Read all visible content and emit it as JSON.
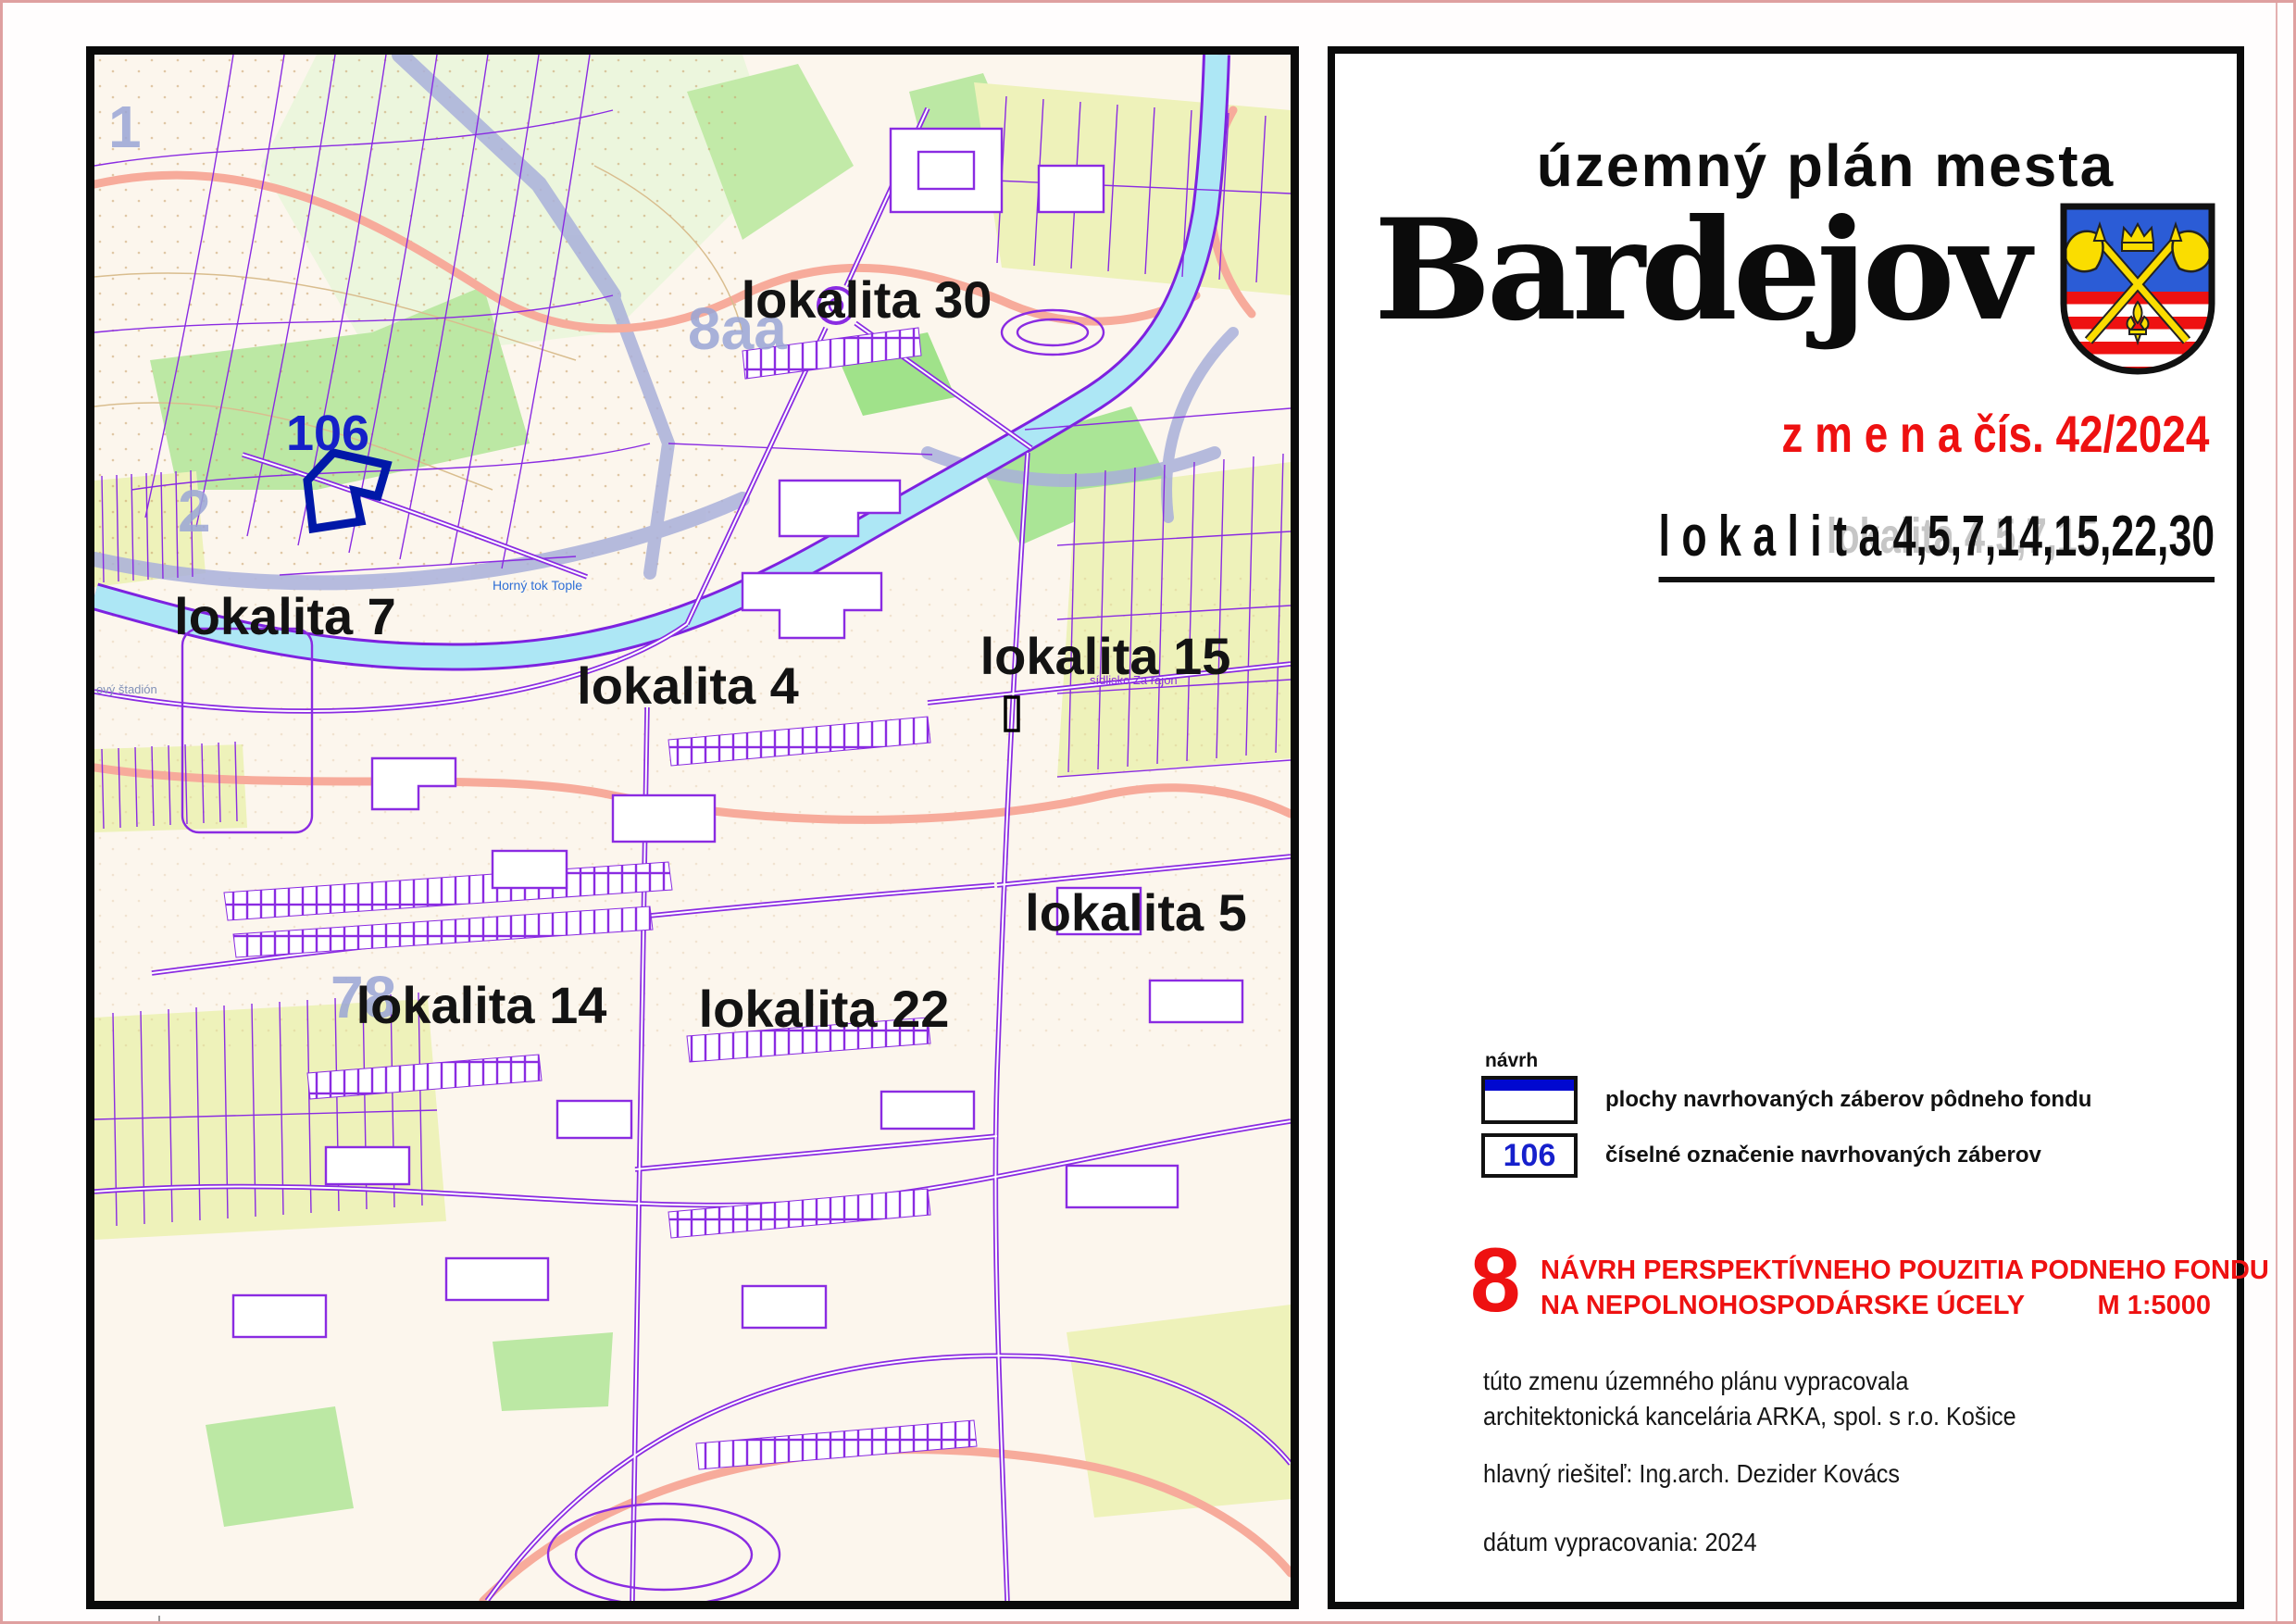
{
  "document": {
    "title_small": "územný plán mesta",
    "city": "Bardejov",
    "change_line": "z m e n a  čís. 42/2024",
    "localities_line": "l o k a l i t a  4,5,7,14,15,22,30",
    "localities_ghost": "lokalita  4,5,7,15",
    "legend": {
      "heading": "návrh",
      "area_label": "plochy navrhovaných záberov pôdneho fondu",
      "area_number": "106",
      "number_label": "číselné označenie navrhovaných záberov"
    },
    "section": {
      "number": "8",
      "title_line1": "NÁVRH PERSPEKTÍVNEHO POUZITIA PODNEHO FONDU",
      "title_line2": "NA NEPOLNOHOSPODÁRSKE ÚCELY",
      "scale": "M 1:5000"
    },
    "credits": {
      "line1": "túto zmenu územného plánu vypracovala",
      "line2": "architektonická kancelária ARKA, spol. s r.o. Košice",
      "line3": "hlavný riešiteľ: Ing.arch. Dezider Kovács",
      "line4": "dátum vypracovania: 2024"
    }
  },
  "map": {
    "locality_labels": [
      {
        "text": "lokalita 30"
      },
      {
        "text": "lokalita 7"
      },
      {
        "text": "lokalita 4"
      },
      {
        "text": "lokalita 15"
      },
      {
        "text": "lokalita 5"
      },
      {
        "text": "lokalita 14"
      },
      {
        "text": "lokalita 22"
      }
    ],
    "area_number": "106",
    "sheet_numbers": [
      {
        "text": "1"
      },
      {
        "text": "2"
      },
      {
        "text": "8aa"
      },
      {
        "text": "78"
      }
    ],
    "minor_labels": {
      "river": "Horný tok Tople",
      "district": "sídlisko Za rajon",
      "stadium": "ový štadión"
    }
  },
  "colors": {
    "accent_red": "#ee1111",
    "legend_blue": "#0008d0",
    "proposal_navy": "#0018a8",
    "map_purple": "#8a2be2",
    "river_cyan": "#ade7f5",
    "shield_blue": "#2b5cd6",
    "shield_yellow": "#fadd00"
  }
}
